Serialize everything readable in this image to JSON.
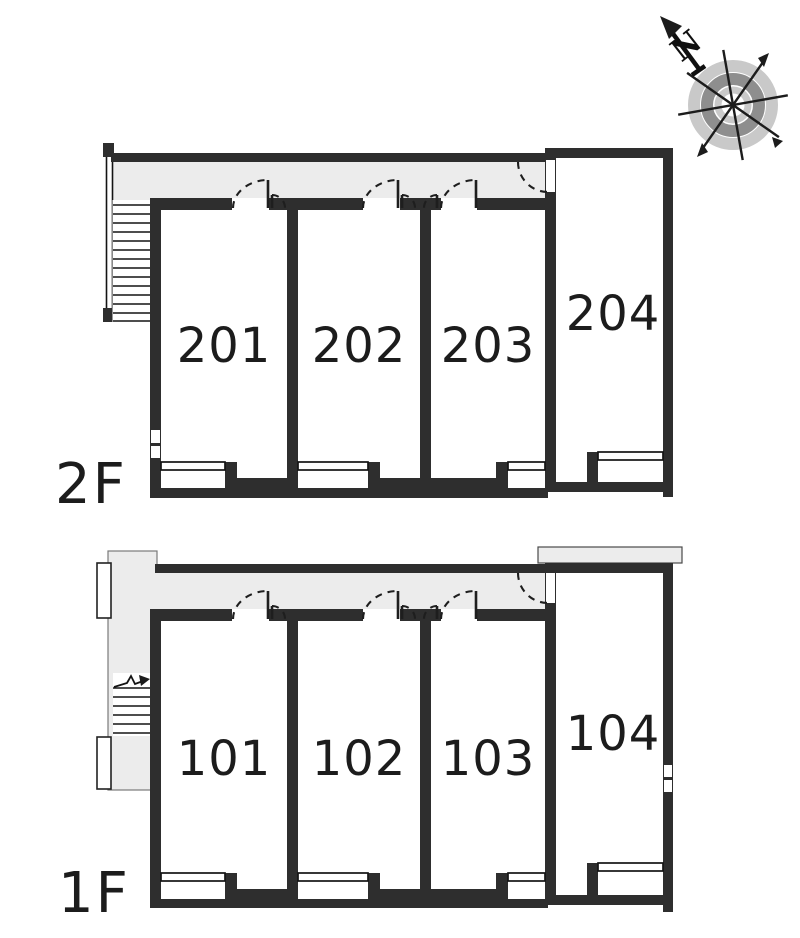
{
  "title": "Apartment unit layout floor plan",
  "compass": {
    "north_label": "N"
  },
  "floors": [
    {
      "label": "2F",
      "rooms": [
        {
          "number": "201"
        },
        {
          "number": "202"
        },
        {
          "number": "203"
        },
        {
          "number": "204"
        }
      ]
    },
    {
      "label": "1F",
      "rooms": [
        {
          "number": "101"
        },
        {
          "number": "102"
        },
        {
          "number": "103"
        },
        {
          "number": "104"
        }
      ]
    }
  ],
  "colors": {
    "wall": "#2e2e2e",
    "corridor_fill": "#ececec",
    "compass_light": "#c9c9c9",
    "compass_dark": "#8e8e8e",
    "text": "#1c1c1c",
    "background": "#ffffff"
  }
}
